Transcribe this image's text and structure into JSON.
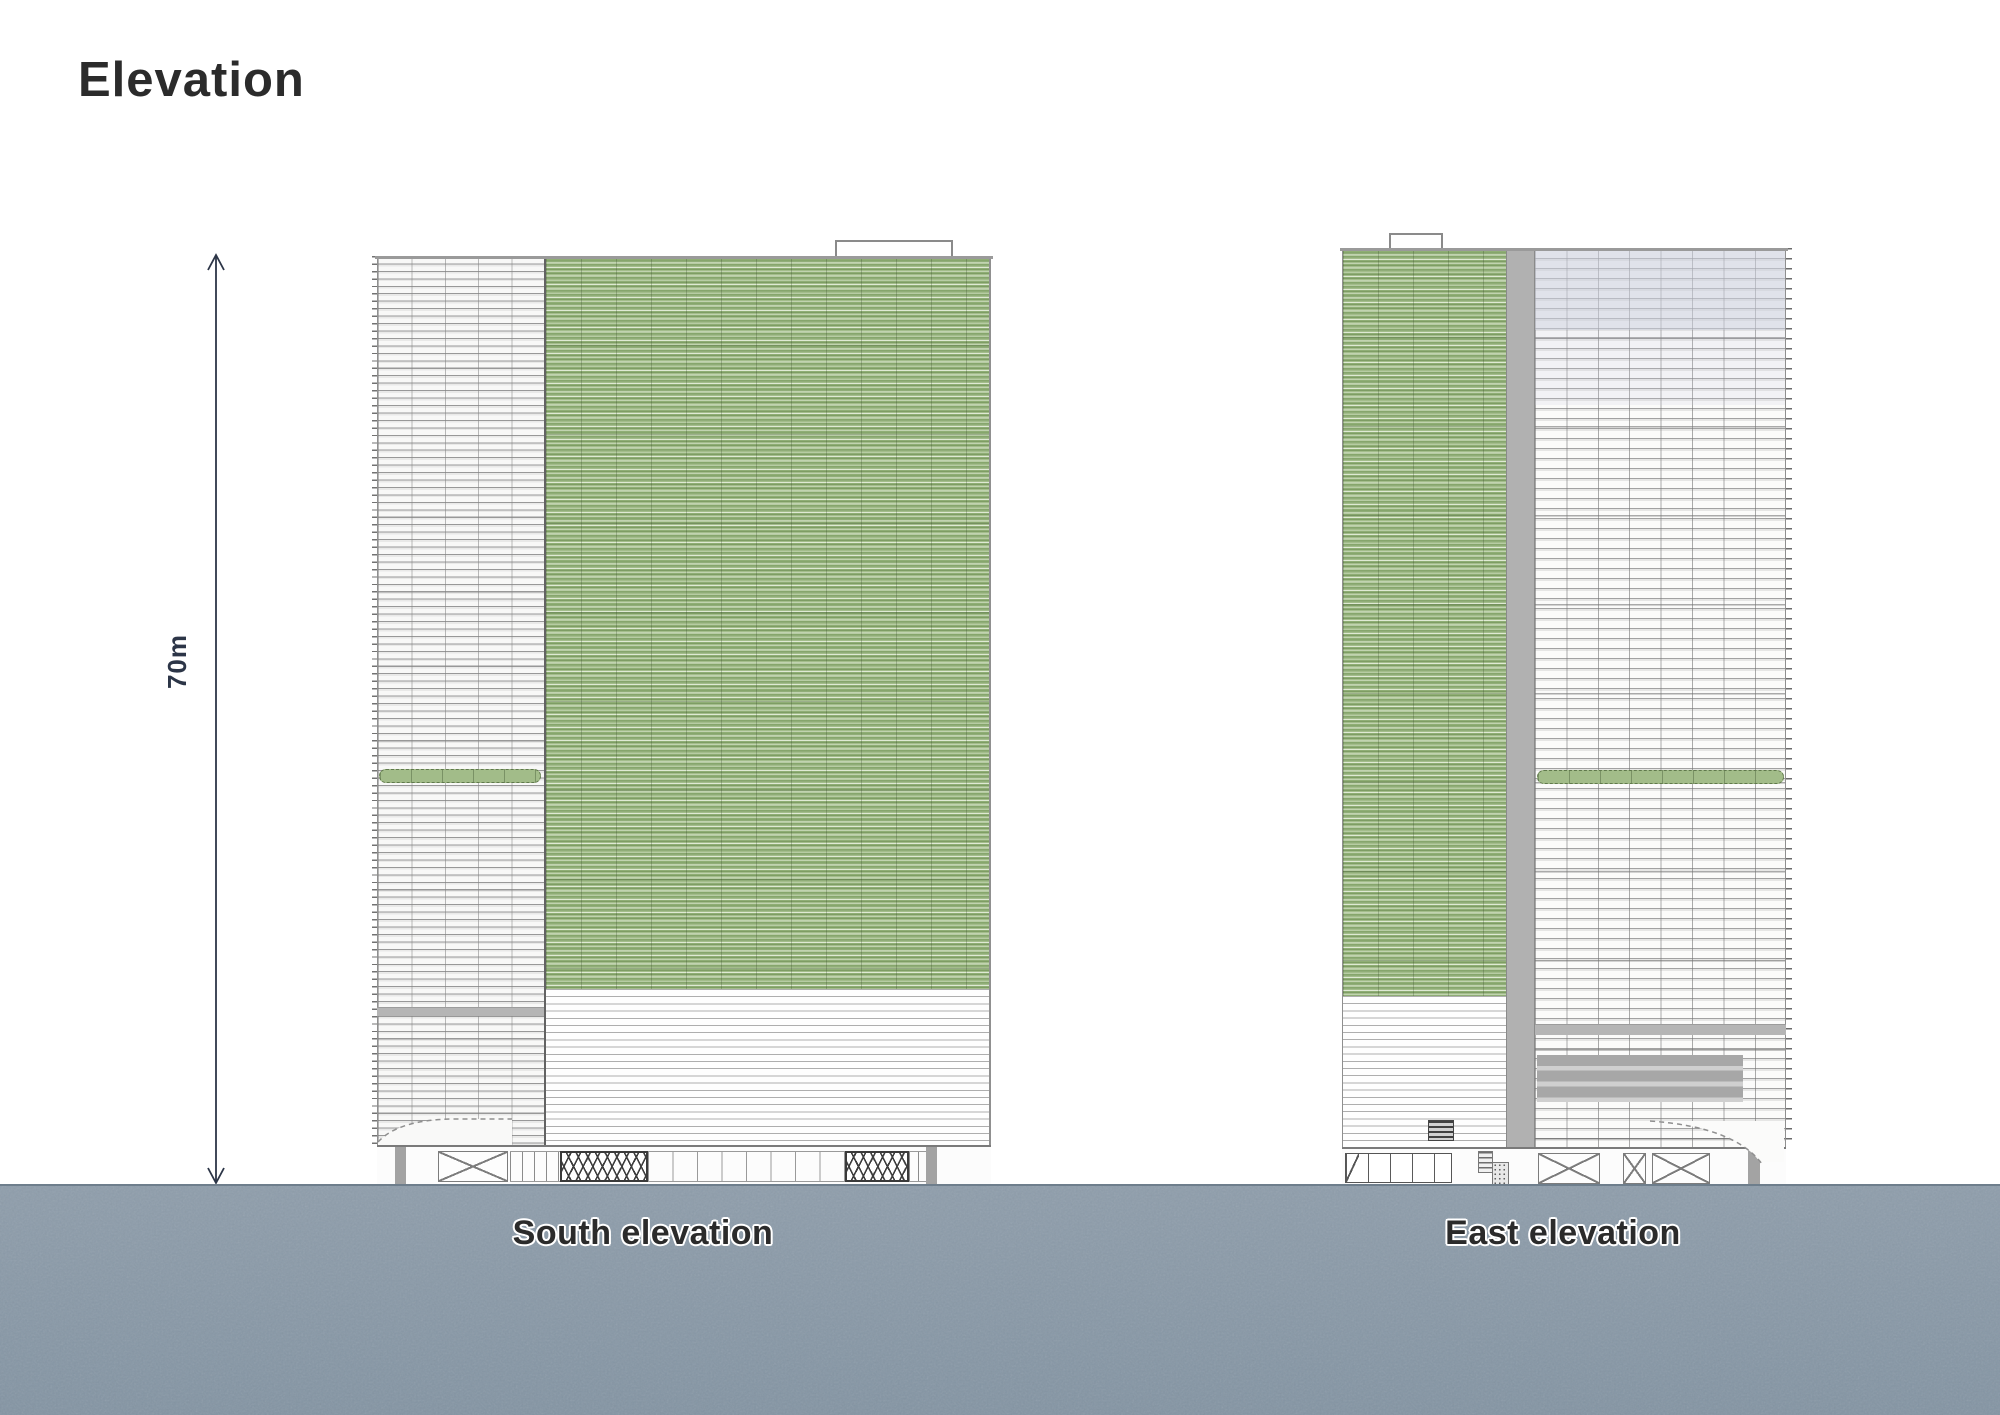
{
  "sheet": {
    "title": "Elevation"
  },
  "dimension": {
    "label": "70m",
    "arrow_icon": "double-headed-vertical-arrow"
  },
  "drawings": {
    "south": {
      "label": "South elevation"
    },
    "east": {
      "label": "East elevation"
    }
  },
  "colors": {
    "title_ink": "#2b2b2b",
    "label_ink": "#2b2b2b",
    "dimension_ink": "#2c3547",
    "facade_green": "#a3bd8b",
    "facade_green_light": "#dfe9d4",
    "facade_green_dark": "#7e9d64",
    "core_gray": "#b1b1b1",
    "band_gray": "#b5b5b5",
    "tint_lavender": "#cbcddd",
    "line_gray": "#9a9a9a",
    "ground": "#8e9dab"
  }
}
